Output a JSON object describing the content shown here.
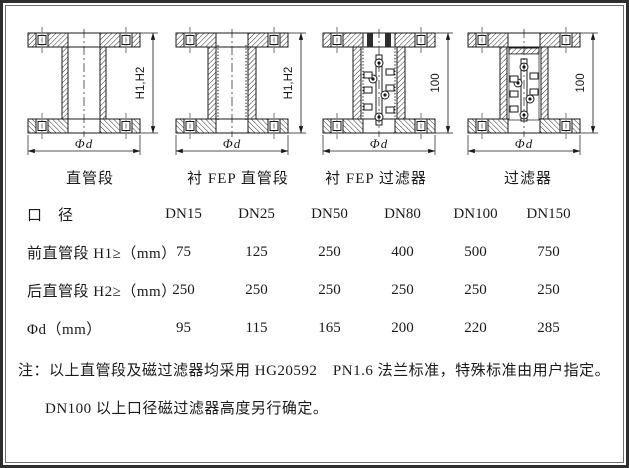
{
  "page": {
    "background": "#ffffff",
    "line_color": "#1a1a1a"
  },
  "diagrams": [
    {
      "label": "直管段",
      "dim_height": "H1,H2",
      "dim_width": "Φd"
    },
    {
      "label": "衬 FEP 直管段",
      "dim_height": "H1,H2",
      "dim_width": "Φd"
    },
    {
      "label": "衬 FEP 过滤器",
      "dim_height": "100",
      "dim_width": "Φd"
    },
    {
      "label": "过滤器",
      "dim_height": "100",
      "dim_width": "Φd"
    }
  ],
  "table": {
    "diameter_label": "口　径",
    "columns": [
      "DN15",
      "DN25",
      "DN50",
      "DN80",
      "DN100",
      "DN150"
    ],
    "rows": [
      {
        "label": "前直管段 H1≥（mm）",
        "values": [
          "75",
          "125",
          "250",
          "400",
          "500",
          "750"
        ]
      },
      {
        "label": "后直管段 H2≥（mm）",
        "values": [
          "250",
          "250",
          "250",
          "250",
          "250",
          "250"
        ]
      },
      {
        "label": "Φd（mm）",
        "values": [
          "95",
          "115",
          "165",
          "200",
          "220",
          "285"
        ]
      }
    ]
  },
  "notes": {
    "line1": "注：以上直管段及磁过滤器均采用 HG20592　PN1.6 法兰标准，特殊标准由用户指定。",
    "line2": "DN100 以上口径磁过滤器高度另行确定。"
  }
}
